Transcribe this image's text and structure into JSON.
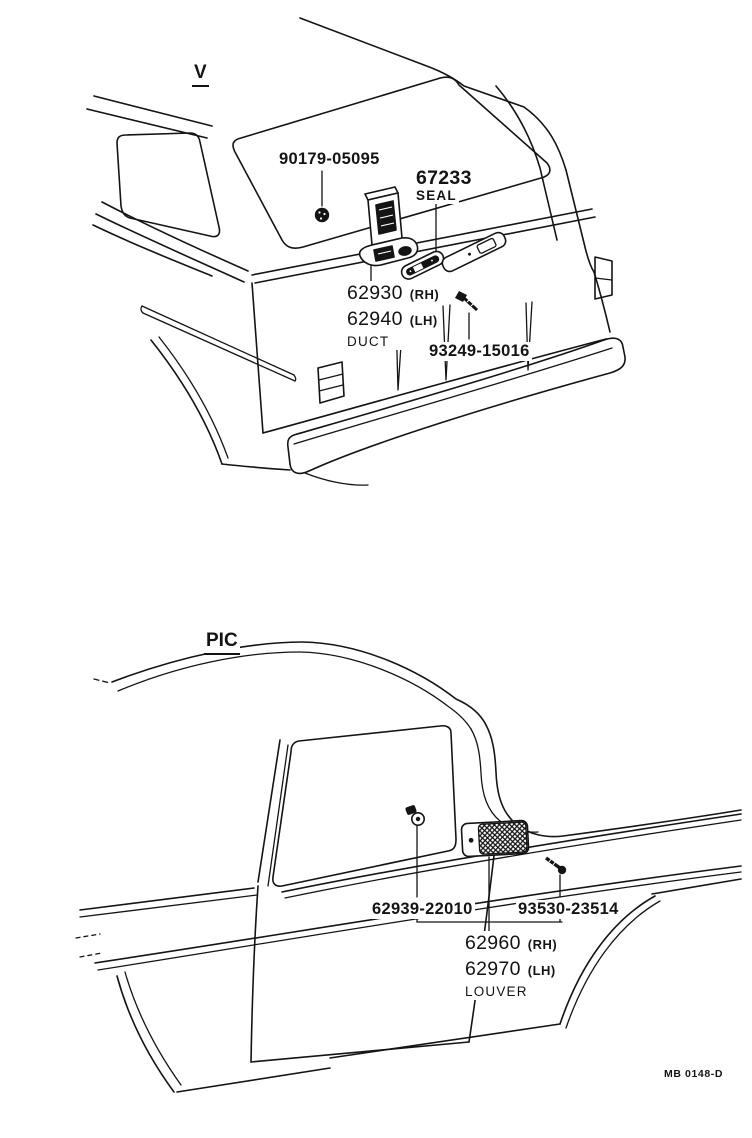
{
  "page": {
    "figure_code": "MB 0148-D",
    "line_color": "#141414",
    "background": "#ffffff"
  },
  "top_view": {
    "view_label": "V",
    "parts": {
      "grommet_number": "90179-05095",
      "seal_number": "67233",
      "seal_caption": "SEAL",
      "duct_numbers": [
        {
          "number": "62930",
          "side": "(RH)"
        },
        {
          "number": "62940",
          "side": "(LH)"
        }
      ],
      "duct_caption": "DUCT",
      "screw_number": "93249-15016"
    }
  },
  "bottom_view": {
    "view_label": "PIC",
    "parts": {
      "clip_number": "62939-22010",
      "screw_number": "93530-23514",
      "louver_numbers": [
        {
          "number": "62960",
          "side": "(RH)"
        },
        {
          "number": "62970",
          "side": "(LH)"
        }
      ],
      "louver_caption": "LOUVER"
    }
  }
}
